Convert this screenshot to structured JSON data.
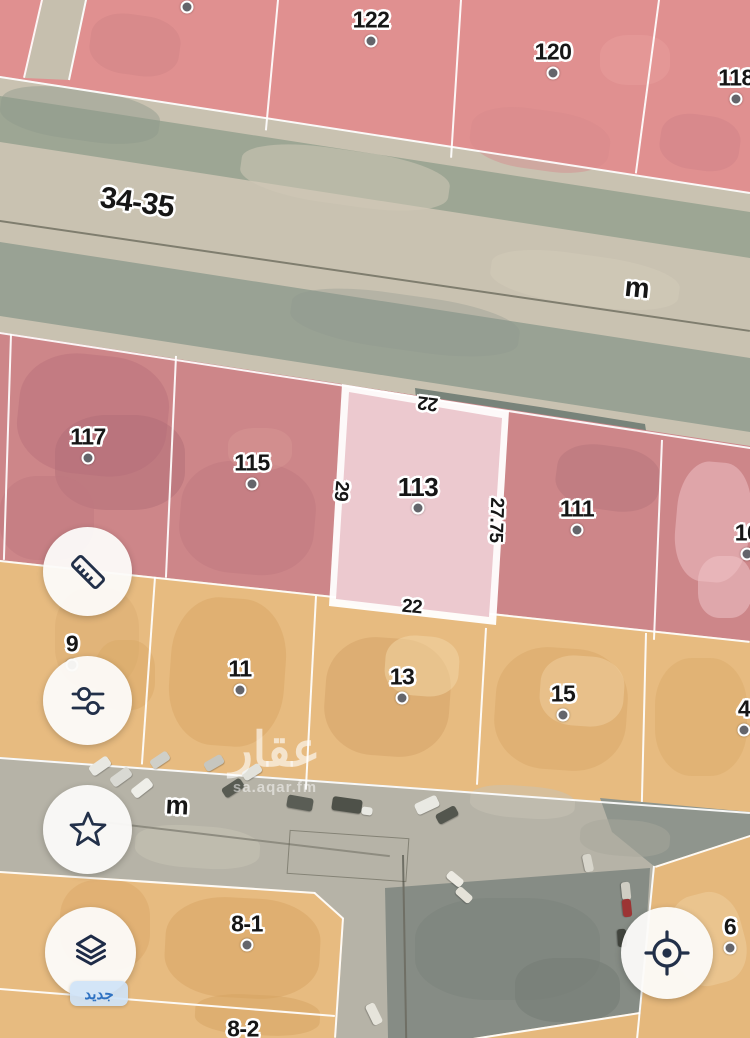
{
  "app": {
    "name": "aqar-map-view"
  },
  "map": {
    "watermark": {
      "title": "عقار",
      "site": "sa.aqar.fm"
    },
    "selected_parcel": {
      "id": "113",
      "width_top": "22",
      "depth_left": "29",
      "depth_right": "27.75",
      "width_bottom": "22"
    },
    "road_labels": [
      {
        "t": "34-35",
        "x": 137,
        "y": 203,
        "rot": 8,
        "size": 30
      },
      {
        "t": "m",
        "x": 637,
        "y": 288,
        "rot": 6,
        "size": 28
      },
      {
        "t": "m",
        "x": 177,
        "y": 805,
        "rot": 3,
        "size": 26
      }
    ],
    "parcel_labels": [
      {
        "t": "",
        "x": 187,
        "y": -14,
        "dot": true
      },
      {
        "t": "122",
        "x": 371,
        "y": 20,
        "dot": true
      },
      {
        "t": "120",
        "x": 553,
        "y": 52,
        "dot": true
      },
      {
        "t": "118",
        "x": 736,
        "y": 78,
        "dot": true
      },
      {
        "t": "117",
        "x": 88,
        "y": 437,
        "dot": true
      },
      {
        "t": "115",
        "x": 252,
        "y": 463,
        "dot": true
      },
      {
        "t": "113",
        "x": 418,
        "y": 487,
        "size": 26,
        "dot": true
      },
      {
        "t": "111",
        "x": 577,
        "y": 509,
        "dot": true
      },
      {
        "t": "10",
        "x": 747,
        "y": 533,
        "dot": true
      },
      {
        "t": "9",
        "x": 72,
        "y": 644,
        "dot": true
      },
      {
        "t": "11",
        "x": 240,
        "y": 669,
        "dot": true
      },
      {
        "t": "13",
        "x": 402,
        "y": 677,
        "dot": true
      },
      {
        "t": "15",
        "x": 563,
        "y": 694,
        "dot": true
      },
      {
        "t": "4",
        "x": 744,
        "y": 709,
        "dot": true
      },
      {
        "t": "8-1",
        "x": 247,
        "y": 924,
        "dot": true
      },
      {
        "t": "8-2",
        "x": 243,
        "y": 1029,
        "dot": true
      },
      {
        "t": "6",
        "x": 730,
        "y": 927,
        "dot": true
      }
    ],
    "dimension_labels": [
      {
        "t": "22",
        "x": 428,
        "y": 403,
        "rot": 187
      },
      {
        "t": "29",
        "x": 341,
        "y": 491,
        "rot": 95
      },
      {
        "t": "27.75",
        "x": 496,
        "y": 520,
        "rot": 92
      },
      {
        "t": "22",
        "x": 412,
        "y": 607,
        "rot": 5
      }
    ],
    "cars": [
      {
        "x": 100,
        "y": 766,
        "w": 22,
        "h": 11,
        "rot": -35,
        "c": "#e8e8e2"
      },
      {
        "x": 121,
        "y": 777,
        "w": 22,
        "h": 11,
        "rot": -36,
        "c": "#d9d9d3"
      },
      {
        "x": 142,
        "y": 788,
        "w": 22,
        "h": 11,
        "rot": -38,
        "c": "#eeeee8"
      },
      {
        "x": 160,
        "y": 760,
        "w": 20,
        "h": 10,
        "rot": -34,
        "c": "#cfcfc8"
      },
      {
        "x": 214,
        "y": 763,
        "w": 20,
        "h": 10,
        "rot": -30,
        "c": "#c6c6bf"
      },
      {
        "x": 233,
        "y": 788,
        "w": 22,
        "h": 11,
        "rot": -33,
        "c": "#585b52"
      },
      {
        "x": 252,
        "y": 772,
        "w": 20,
        "h": 10,
        "rot": -32,
        "c": "#e2e2db"
      },
      {
        "x": 300,
        "y": 803,
        "w": 26,
        "h": 13,
        "rot": 10,
        "c": "#5a5d55"
      },
      {
        "x": 347,
        "y": 805,
        "w": 30,
        "h": 14,
        "rot": 8,
        "c": "#4e5149"
      },
      {
        "x": 367,
        "y": 811,
        "w": 11,
        "h": 8,
        "rot": 8,
        "c": "#e9e9e3"
      },
      {
        "x": 427,
        "y": 805,
        "w": 24,
        "h": 12,
        "rot": -25,
        "c": "#e9e9e3"
      },
      {
        "x": 447,
        "y": 815,
        "w": 22,
        "h": 11,
        "rot": -28,
        "c": "#53564e"
      },
      {
        "x": 455,
        "y": 879,
        "w": 18,
        "h": 9,
        "rot": 40,
        "c": "#eceae2"
      },
      {
        "x": 464,
        "y": 895,
        "w": 18,
        "h": 9,
        "rot": 42,
        "c": "#e4e2d8"
      },
      {
        "x": 588,
        "y": 863,
        "w": 18,
        "h": 9,
        "rot": 78,
        "c": "#d7d5cb"
      },
      {
        "x": 626,
        "y": 891,
        "w": 18,
        "h": 9,
        "rot": 84,
        "c": "#cfcdc3"
      },
      {
        "x": 627,
        "y": 908,
        "w": 18,
        "h": 9,
        "rot": 84,
        "c": "#9c3434"
      },
      {
        "x": 622,
        "y": 938,
        "w": 18,
        "h": 9,
        "rot": 86,
        "c": "#42453e"
      },
      {
        "x": 374,
        "y": 1014,
        "w": 22,
        "h": 10,
        "rot": 64,
        "c": "#e6e4db"
      }
    ]
  },
  "controls": {
    "new_badge": "جديد",
    "left_buttons": [
      {
        "name": "measure"
      },
      {
        "name": "filters"
      },
      {
        "name": "favorites"
      },
      {
        "name": "layers"
      }
    ],
    "locate_button": {
      "name": "locate"
    }
  },
  "colors": {
    "parcel_pink": "#e09090",
    "parcel_pink_dark": "#cd8689",
    "parcel_selected": "#ecc9cf",
    "parcel_orange": "#e7bb80",
    "icon_navy": "#223049",
    "badge_blue": "#2f72c2"
  }
}
